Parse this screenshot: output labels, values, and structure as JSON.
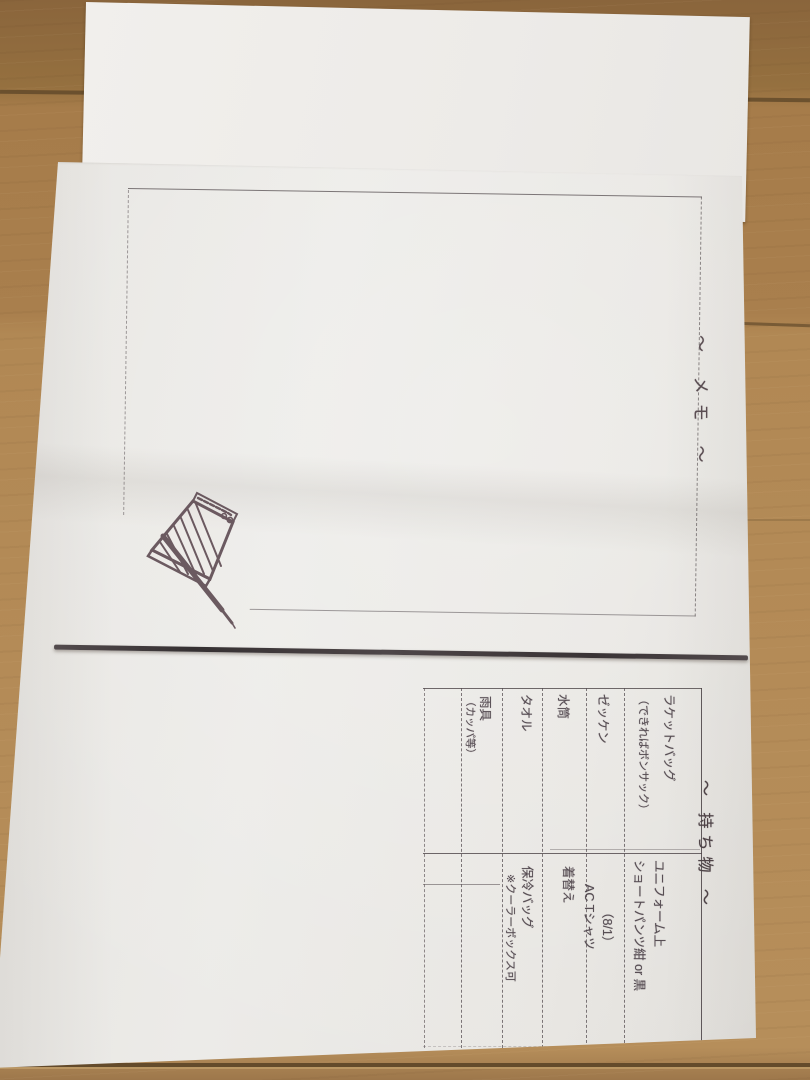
{
  "scene": {
    "description": "Photograph of a folded paper handout lying on a wooden floor, rotated 90 degrees clockwise",
    "colors": {
      "wood": "#ab8150",
      "wood_seam": "#5c4527",
      "paper": "#e9e7e3",
      "under_paper": "#efedea",
      "ink": "#4d434a",
      "thick_rule": "#3b3537"
    }
  },
  "memo_page": {
    "title": "〜 メモ 〜",
    "stamp_icon": "notepad-pencil-stamp"
  },
  "items_page": {
    "title": "〜 持ち物 〜",
    "table": {
      "columns": 2,
      "rows": [
        {
          "col1": [
            "ラケットバッグ",
            "（できればボンサック）"
          ],
          "col2": [
            "ユニフォーム上",
            "ショートパンツ紺 or 黒"
          ]
        },
        {
          "col1": [
            "ゼッケン"
          ],
          "col2": [
            "（8/1）",
            "AC Tシャツ"
          ]
        },
        {
          "col1": [
            "水筒"
          ],
          "col2": [
            "着替え"
          ]
        },
        {
          "col1": [
            "タオル"
          ],
          "col2": [
            "保冷バッグ",
            "※クーラーボックス可"
          ]
        },
        {
          "col1": [
            "雨具",
            "（カッパ等）"
          ],
          "col2": []
        },
        {
          "col1": [],
          "col2": []
        }
      ]
    }
  }
}
